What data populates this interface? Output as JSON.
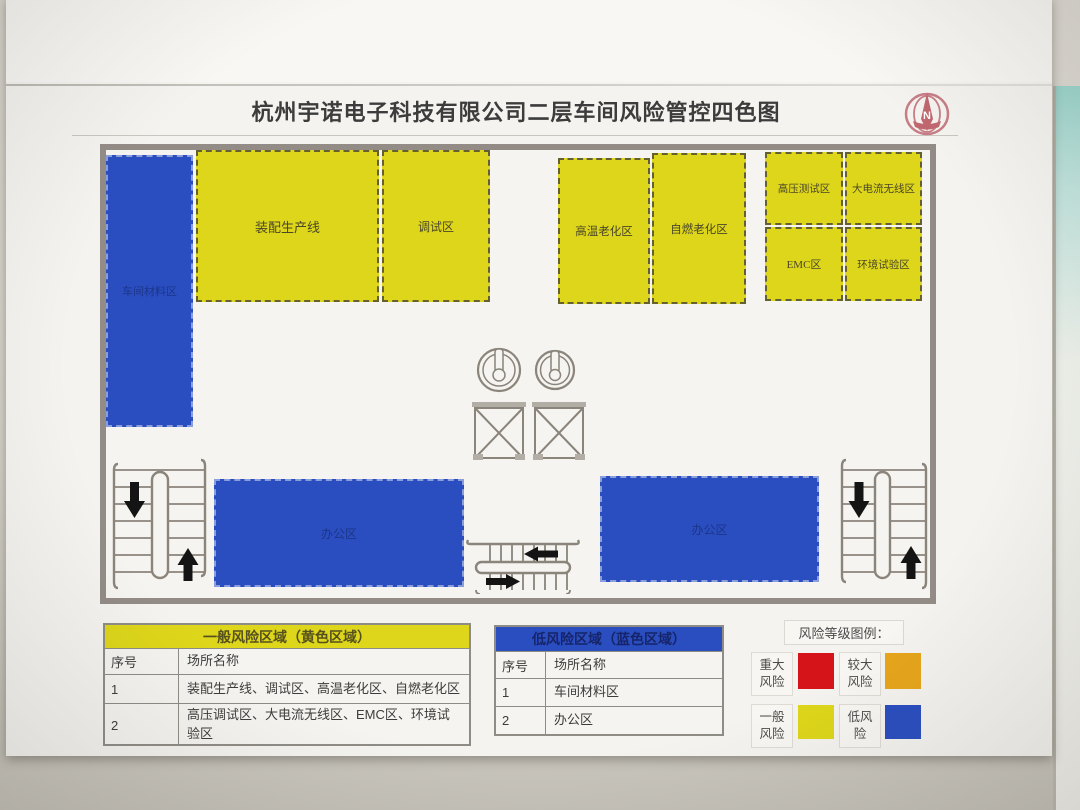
{
  "title": "杭州宇诺电子科技有限公司二层车间风险管控四色图",
  "logo": {
    "letter": "N"
  },
  "map_zones": {
    "material": {
      "label": "车间材料区"
    },
    "assembly": {
      "label": "装配生产线"
    },
    "debug": {
      "label": "调试区"
    },
    "high_temp": {
      "label": "高温老化区"
    },
    "self_ignite": {
      "label": "自燃老化区"
    },
    "high_voltage": {
      "label": "高压测试区"
    },
    "high_current": {
      "label": "大电流无线区"
    },
    "emc": {
      "label": "EMC区"
    },
    "environment": {
      "label": "环境试验区"
    },
    "office_left": {
      "label": "办公区"
    },
    "office_right": {
      "label": "办公区"
    }
  },
  "tables": {
    "yellow": {
      "header": "一般风险区域（黄色区域）",
      "col_no": "序号",
      "col_name": "场所名称",
      "rows": [
        {
          "no": "1",
          "name": "装配生产线、调试区、高温老化区、自燃老化区"
        },
        {
          "no": "2",
          "name": "高压调试区、大电流无线区、EMC区、环境试验区"
        }
      ]
    },
    "blue": {
      "header": "低风险区域（蓝色区域）",
      "col_no": "序号",
      "col_name": "场所名称",
      "rows": [
        {
          "no": "1",
          "name": "车间材料区"
        },
        {
          "no": "2",
          "name": "办公区"
        }
      ]
    }
  },
  "legend": {
    "title": "风险等级图例：",
    "items": [
      {
        "label": "重大风险",
        "color": "#d41418"
      },
      {
        "label": "较大风险",
        "color": "#e6a51b"
      },
      {
        "label": "一般风险",
        "color": "#ddd61a"
      },
      {
        "label": "低风险",
        "color": "#2a4ec0"
      }
    ]
  },
  "colors": {
    "zone_yellow": "#ddd61a",
    "zone_blue": "#2a4ec0",
    "map_border": "#938b85",
    "paper": "#f4f3ef"
  }
}
